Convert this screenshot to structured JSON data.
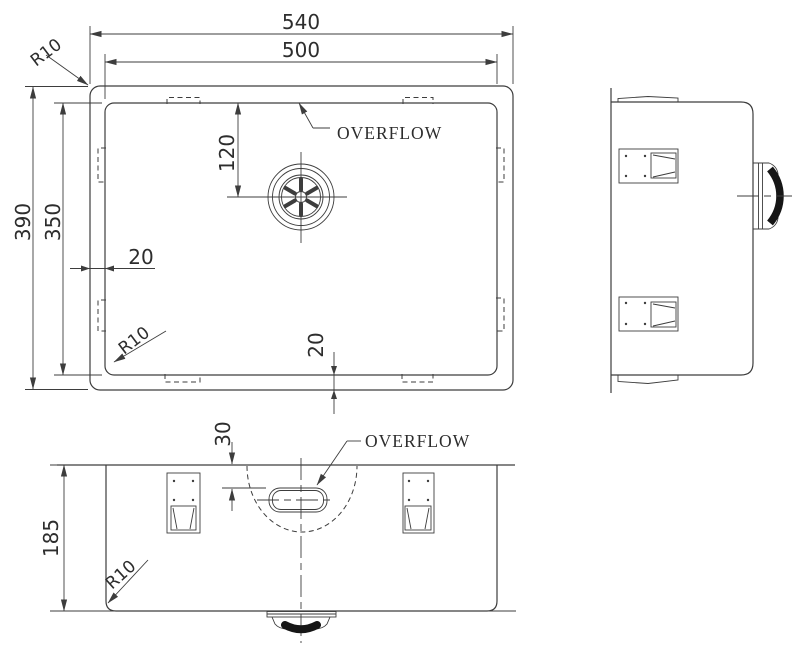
{
  "title": "Undermount sink technical drawing, three orthographic views",
  "colors": {
    "ink": "#3d3d3d",
    "text": "#2d2d2d",
    "dark_fill": "#161616",
    "background": "#ffffff"
  },
  "top_view": {
    "width_outer": "540",
    "width_inner": "500",
    "depth_outer": "390",
    "depth_inner": "350",
    "drain_from_back": "120",
    "rim_side": "20",
    "rim_bottom": "20",
    "corner_radius": "R10",
    "bowl_corner_radius": "R10",
    "overflow_label": "OVERFLOW"
  },
  "front_view": {
    "height": "185",
    "overflow_from_rim": "30",
    "bottom_corner_radius": "R10",
    "overflow_label": "OVERFLOW"
  }
}
